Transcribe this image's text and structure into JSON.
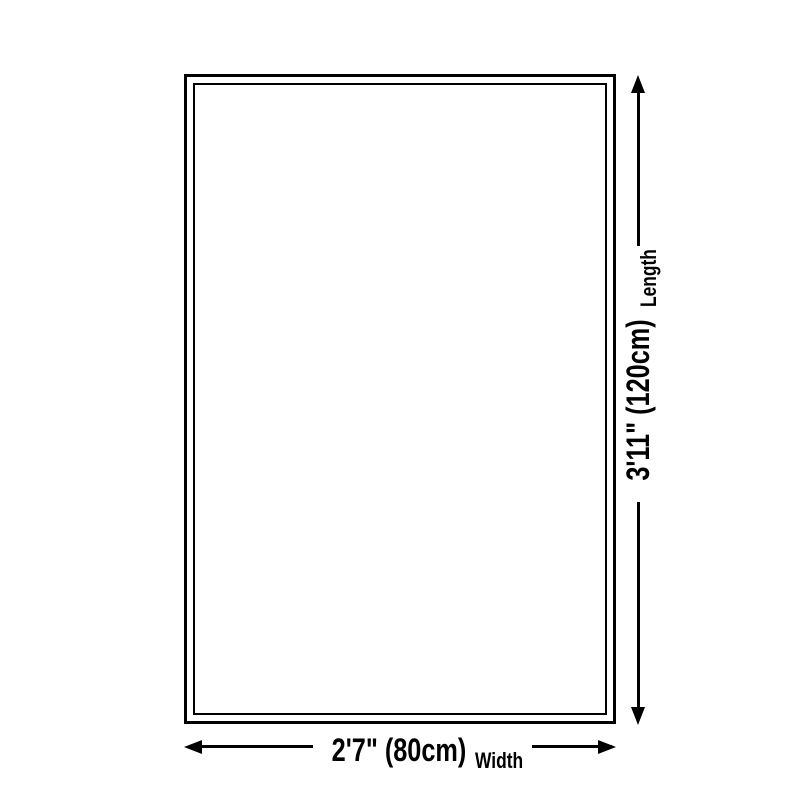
{
  "diagram": {
    "type": "product-dimension-diagram",
    "background_color": "#ffffff",
    "line_color": "#000000",
    "length": {
      "value": "3'11\" (120cm)",
      "label": "Length",
      "cm": 120
    },
    "width": {
      "value": "2'7\" (80cm)",
      "label": "Width",
      "cm": 80
    }
  }
}
